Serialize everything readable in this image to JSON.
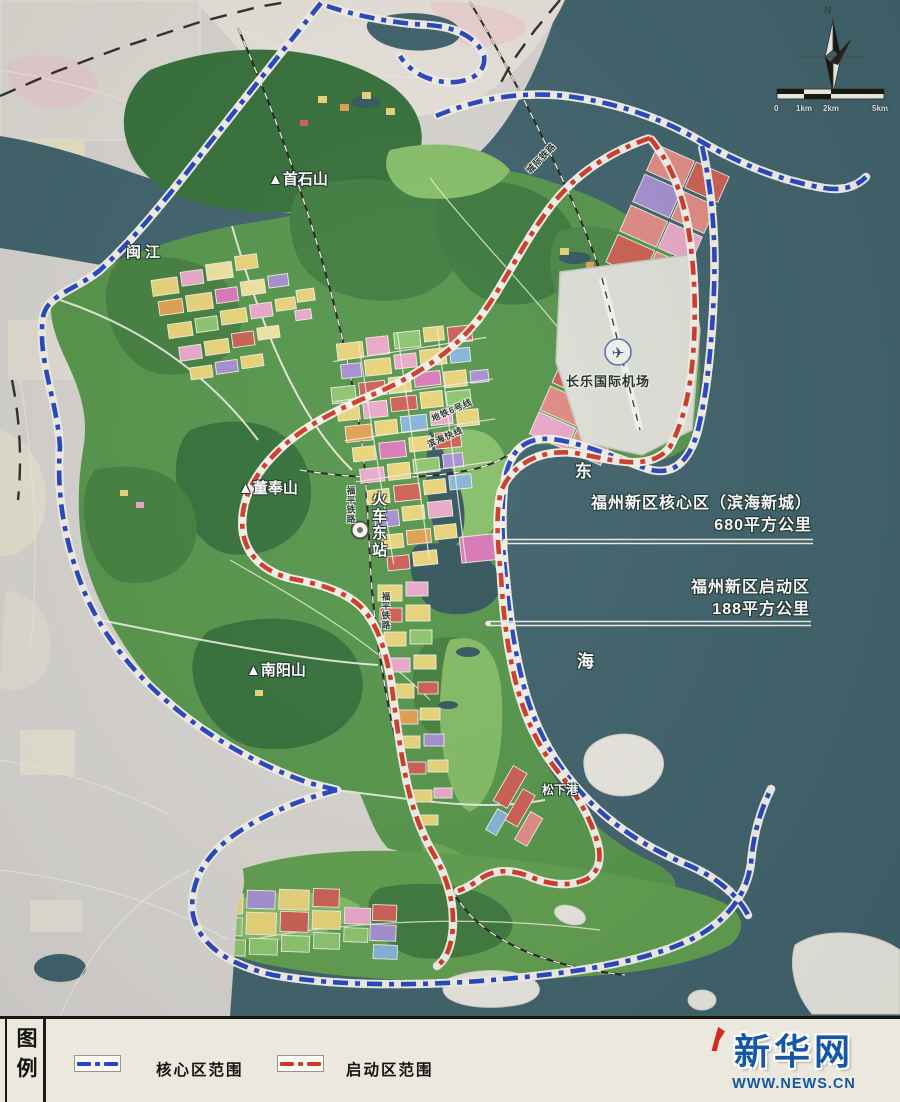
{
  "map": {
    "place_labels": {
      "shoushi_mountain": "▲首石山",
      "min_river": "闽江",
      "dongfeng_mountain": "▲董奉山",
      "nanyang_mountain": "▲南阳山",
      "railway_east_station": "火车东站",
      "changle_airport": "长乐国际机场",
      "songxia_port": "松下港",
      "east_sea_char1": "东",
      "east_sea_char2": "海",
      "fuping_railway": "福平铁路",
      "intercity_railway": "城际铁路",
      "metro_line6": "地铁6号线",
      "binhai_express": "滨海快线"
    },
    "annotations": {
      "core_area": {
        "line1": "福州新区核心区（滨海新城）",
        "line2": "680平方公里"
      },
      "startup_area": {
        "line1": "福州新区启动区",
        "line2": "188平方公里"
      }
    },
    "compass_north": "N",
    "scale_bar": {
      "tick0": "0",
      "tick1": "1km",
      "tick2": "2km",
      "tick3": "5km"
    }
  },
  "legend": {
    "title": "图例",
    "core_item": {
      "label": "核心区范围",
      "color": "#2746c0"
    },
    "startup_item": {
      "label": "启动区范围",
      "color": "#cf3a28"
    }
  },
  "branding": {
    "site_name": "新华网",
    "site_url": "WWW.NEWS.CN",
    "brand_color": "#1557a6"
  },
  "colors": {
    "sea": "#3f626b",
    "outside_land": "#d7d4d0",
    "mainland_green": "#55954a",
    "core_boundary": "#2746c0",
    "startup_boundary": "#cf3a28"
  }
}
